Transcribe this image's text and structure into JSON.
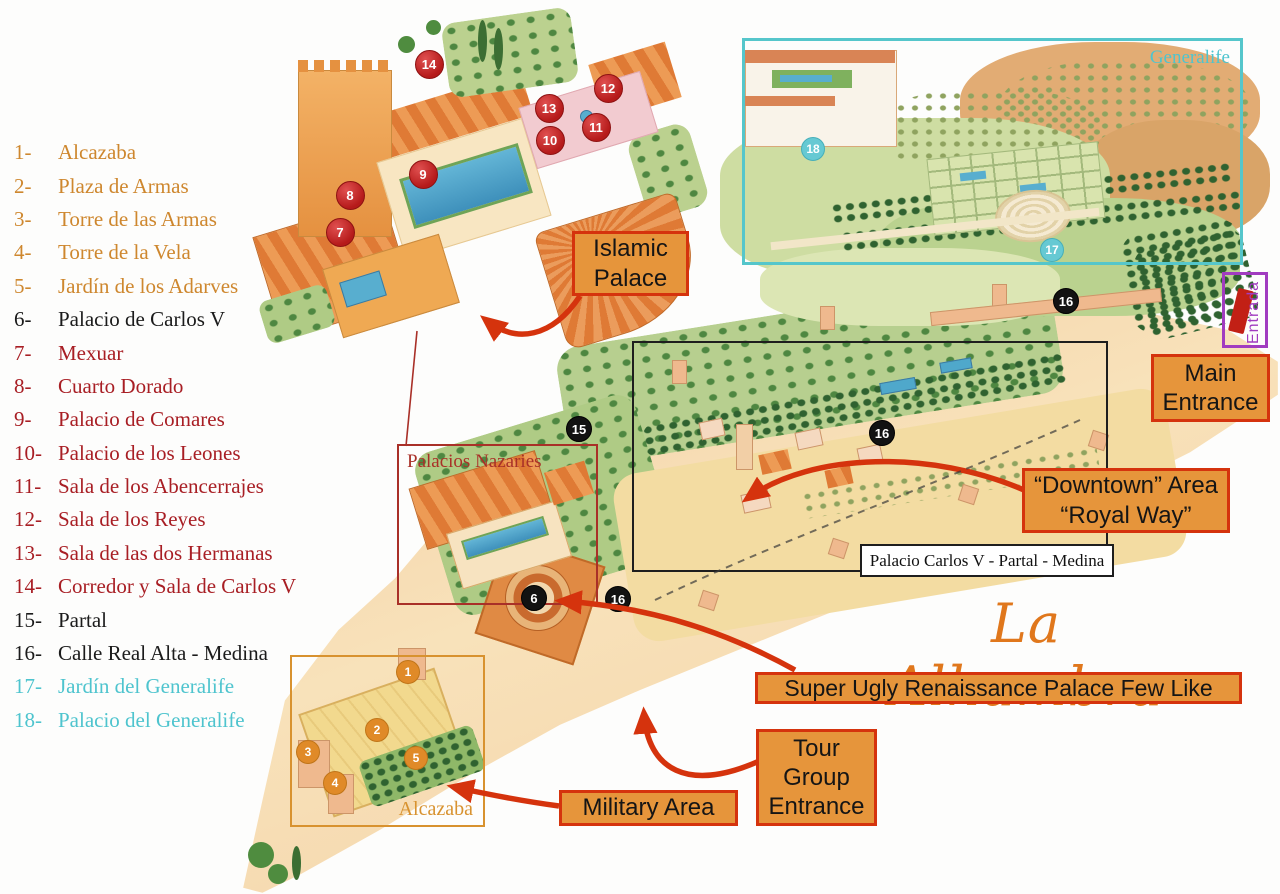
{
  "title": "La Alhambra",
  "colors": {
    "callout_fill": "#E6953B",
    "callout_border": "#D5330D",
    "title_orange": "#E0771C",
    "purple": "#A13CC0",
    "cyan_rect": "#55C6CB",
    "legend": {
      "orange": "#CE872E",
      "red": "#A81E24",
      "black": "#1B1B1B",
      "cyan": "#4EC4CE"
    }
  },
  "legend": {
    "items": [
      {
        "num": "1-",
        "label": "Alcazaba",
        "color": "orange"
      },
      {
        "num": "2-",
        "label": "Plaza de Armas",
        "color": "orange"
      },
      {
        "num": "3-",
        "label": "Torre de las Armas",
        "color": "orange"
      },
      {
        "num": "4-",
        "label": "Torre de la Vela",
        "color": "orange"
      },
      {
        "num": "5-",
        "label": "Jardín de los Adarves",
        "color": "orange"
      },
      {
        "num": "6-",
        "label": "Palacio de Carlos V",
        "color": "black"
      },
      {
        "num": "7-",
        "label": "Mexuar",
        "color": "red"
      },
      {
        "num": "8-",
        "label": "Cuarto Dorado",
        "color": "red"
      },
      {
        "num": "9-",
        "label": "Palacio de Comares",
        "color": "red"
      },
      {
        "num": "10-",
        "label": "Palacio de los Leones",
        "color": "red"
      },
      {
        "num": "11-",
        "label": "Sala de los Abencerrajes",
        "color": "red"
      },
      {
        "num": "12-",
        "label": "Sala de los Reyes",
        "color": "red"
      },
      {
        "num": "13-",
        "label": "Sala de las dos Hermanas",
        "color": "red"
      },
      {
        "num": "14-",
        "label": "Corredor y Sala de Carlos V",
        "color": "red"
      },
      {
        "num": "15-",
        "label": "Partal",
        "color": "black"
      },
      {
        "num": "16-",
        "label": "Calle Real Alta - Medina",
        "color": "black"
      },
      {
        "num": "17-",
        "label": "Jardín del Generalife",
        "color": "cyan"
      },
      {
        "num": "18-",
        "label": "Palacio del Generalife",
        "color": "cyan"
      }
    ]
  },
  "callouts": {
    "islamic_palace": "Islamic\nPalace",
    "main_entrance": "Main\nEntrance",
    "downtown": "“Downtown” Area\n“Royal Way”",
    "super_ugly": "Super Ugly Renaissance Palace Few Like",
    "tour_group": "Tour\nGroup\nEntrance",
    "military": "Military Area"
  },
  "map_labels": {
    "generalife": "Generalife",
    "entrada": "Entrada",
    "palacios_nazaries": "Palacios Nazaries",
    "carlos_strip": "Palacio Carlos V - Partal - Medina",
    "alcazaba": "Alcazaba"
  },
  "markers": {
    "groups": [
      {
        "type": "red",
        "items": [
          {
            "n": "7",
            "x": 339,
            "y": 231
          },
          {
            "n": "8",
            "x": 349,
            "y": 194
          },
          {
            "n": "9",
            "x": 422,
            "y": 173
          },
          {
            "n": "10",
            "x": 549,
            "y": 139
          },
          {
            "n": "11",
            "x": 595,
            "y": 126
          },
          {
            "n": "12",
            "x": 607,
            "y": 87
          },
          {
            "n": "13",
            "x": 548,
            "y": 107
          },
          {
            "n": "14",
            "x": 428,
            "y": 63
          }
        ]
      },
      {
        "type": "black",
        "items": [
          {
            "n": "15",
            "x": 578,
            "y": 428
          },
          {
            "n": "6",
            "x": 533,
            "y": 597
          },
          {
            "n": "16",
            "x": 617,
            "y": 598
          },
          {
            "n": "16",
            "x": 881,
            "y": 432
          },
          {
            "n": "16",
            "x": 1065,
            "y": 300
          }
        ]
      },
      {
        "type": "orange",
        "items": [
          {
            "n": "1",
            "x": 407,
            "y": 671
          },
          {
            "n": "2",
            "x": 376,
            "y": 729
          },
          {
            "n": "3",
            "x": 307,
            "y": 751
          },
          {
            "n": "4",
            "x": 334,
            "y": 782
          },
          {
            "n": "5",
            "x": 415,
            "y": 757
          }
        ]
      },
      {
        "type": "cyan",
        "items": [
          {
            "n": "18",
            "x": 812,
            "y": 148
          },
          {
            "n": "17",
            "x": 1051,
            "y": 249
          }
        ]
      }
    ]
  }
}
